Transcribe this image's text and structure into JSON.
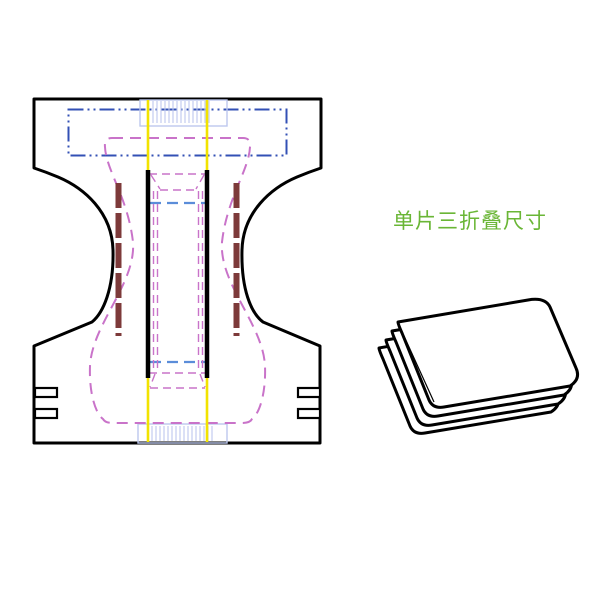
{
  "page": {
    "background_color": "#ffffff"
  },
  "label": {
    "text": "单片三折叠尺寸",
    "color": "#6ab636"
  },
  "drawing": {
    "flat_view_name": "diaper-flat-pattern",
    "folded_view_name": "tri-folded-piece",
    "colors": {
      "page": "#ffffff",
      "outline": "#000000",
      "phantom": "#3350b5",
      "hatch": "#bdc7ee",
      "dash": "#5b8dd9",
      "yellow": "#f2e300",
      "pink": "#c973c9",
      "maroon": "#7d3a3a"
    }
  }
}
